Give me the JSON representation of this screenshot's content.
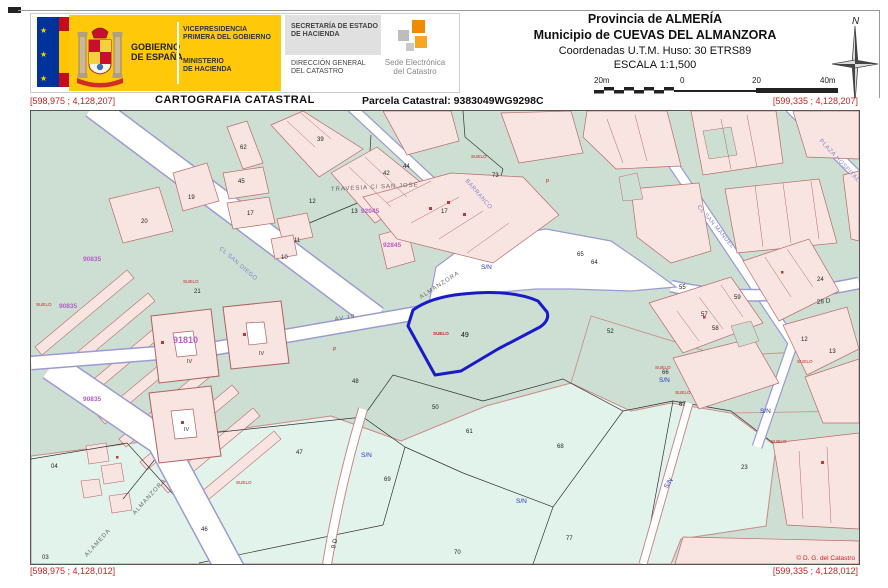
{
  "header": {
    "logo": {
      "gob1": "GOBIERNO",
      "gob2": "DE ESPAÑA",
      "vice1": "VICEPRESIDENCIA",
      "vice2": "PRIMERA DEL GOBIERNO",
      "min1": "MINISTERIO",
      "min2": "DE HACIENDA",
      "sec1": "SECRETARÍA DE ESTADO",
      "sec2": "DE HACIENDA",
      "dir1": "DIRECCIÓN GENERAL",
      "dir2": "DEL CATASTRO",
      "sede1": "Sede Electrónica",
      "sede2": "del Catastro"
    },
    "province_block": {
      "line1": "Provincia de ALMERÍA",
      "line2": "Municipio de CUEVAS DEL ALMANZORA",
      "line3": "Coordenadas U.T.M. Huso: 30 ETRS89",
      "line4": "ESCALA 1:1,500"
    },
    "scalebar": {
      "l0": "20m",
      "l1": "0",
      "l2": "20",
      "l3": "40m"
    },
    "north_label": "N"
  },
  "titlebar": {
    "title": "CARTOGRAFIA CATASTRAL",
    "parcel": "Parcela Catastral: 9383049WG9298C"
  },
  "map": {
    "corners": {
      "tl": "[598,975 ; 4,128,207]",
      "tr": "[599,335 ; 4,128,207]",
      "bl": "[598,975 ; 4,128,012]",
      "br": "[599,335 ; 4,128,012]"
    },
    "copyright": "© D. G. del Catastro",
    "selected_parcel": {
      "landuse": "SUELO",
      "number": "49"
    },
    "sn": "S/N",
    "suelo": "SUELO",
    "p_label": "P",
    "street_labels": [
      "TRAVESIA C/ SAN JOSE",
      "CL SAN DIEGO",
      "ALMANZORA",
      "ALMANZORA",
      "ALAMEDA",
      "AV 10",
      "CL SAN MANUEL",
      "PLAZA HOSPITAL",
      "28 D",
      "9 D",
      "BARRANCO"
    ],
    "zone_codes": [
      "90835",
      "90835",
      "90835",
      "91810",
      "92045",
      "92845"
    ],
    "romans": [
      "IV",
      "IV",
      "IV"
    ],
    "parcels": [
      "20",
      "19",
      "62",
      "45",
      "17",
      "39",
      "44",
      "42",
      "13",
      "17",
      "73",
      "52",
      "48",
      "50",
      "65",
      "64",
      "47",
      "46",
      "04",
      "03",
      "69",
      "61",
      "68",
      "77",
      "70",
      "23",
      "12",
      "55",
      "57",
      "59",
      "66",
      "67",
      "24",
      "21",
      "10",
      "58",
      "13",
      "12",
      "11"
    ]
  },
  "colors": {
    "flag_blue": "#003399",
    "brand_yellow": "#ffcc00",
    "logo_orange": "#f08a00",
    "urban_green": "#ccdfd2",
    "rural_cyan": "#e2f3ec",
    "parcel_pink": "#f8e4e1",
    "street_edge_purple": "#9b9bd4",
    "coordinate_red": "#cc2222",
    "selection_blue": "#1a1ac8"
  }
}
